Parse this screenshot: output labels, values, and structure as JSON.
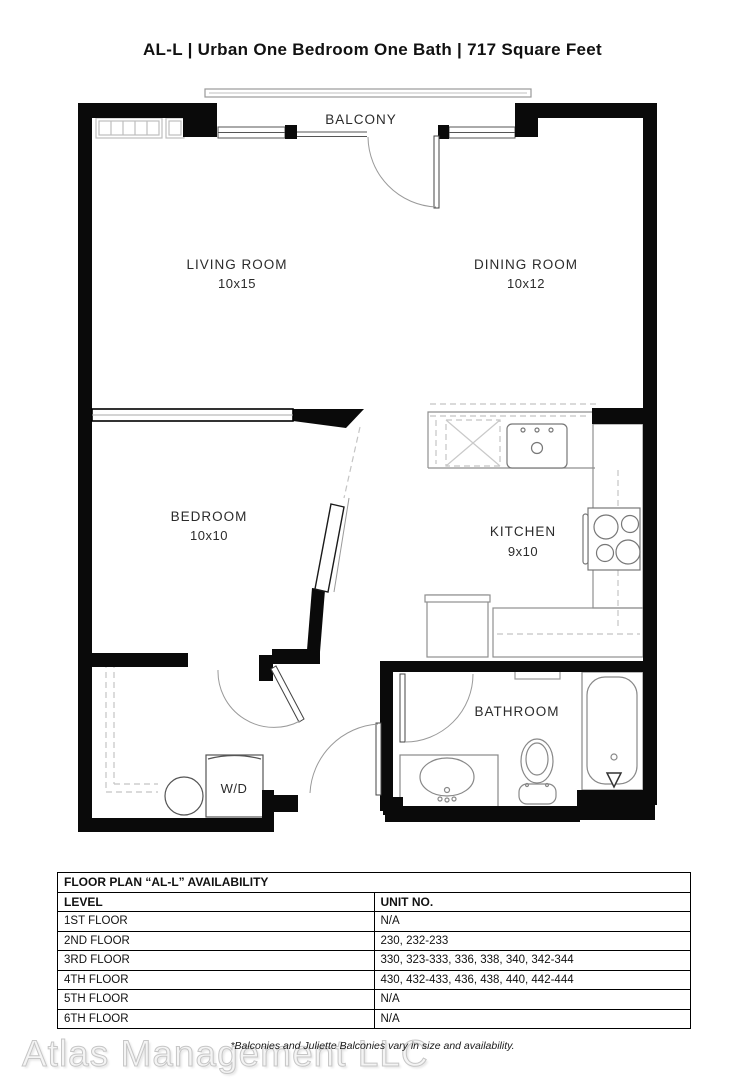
{
  "title": "AL-L | Urban One Bedroom One Bath | 717 Square Feet",
  "floor_plan": {
    "rooms": [
      {
        "name": "BALCONY",
        "dims": ""
      },
      {
        "name": "LIVING ROOM",
        "dims": "10x15"
      },
      {
        "name": "DINING ROOM",
        "dims": "10x12"
      },
      {
        "name": "BEDROOM",
        "dims": "10x10"
      },
      {
        "name": "KITCHEN",
        "dims": "9x10"
      },
      {
        "name": "BATHROOM",
        "dims": ""
      },
      {
        "name": "W/D",
        "dims": ""
      }
    ]
  },
  "availability_table": {
    "title": "FLOOR PLAN “AL-L” AVAILABILITY",
    "columns": [
      "LEVEL",
      "UNIT NO."
    ],
    "rows": [
      {
        "level": "1ST FLOOR",
        "units": "N/A"
      },
      {
        "level": "2ND FLOOR",
        "units": "230, 232-233"
      },
      {
        "level": "3RD FLOOR",
        "units": "330, 323-333, 336, 338, 340, 342-344"
      },
      {
        "level": "4TH FLOOR",
        "units": "430, 432-433, 436, 438, 440, 442-444"
      },
      {
        "level": "5TH FLOOR",
        "units": "N/A"
      },
      {
        "level": "6TH FLOOR",
        "units": "N/A"
      }
    ]
  },
  "footnote": "*Balconies and Juliette Balconies vary in size and availability.",
  "watermark": "Atlas Management LLC"
}
